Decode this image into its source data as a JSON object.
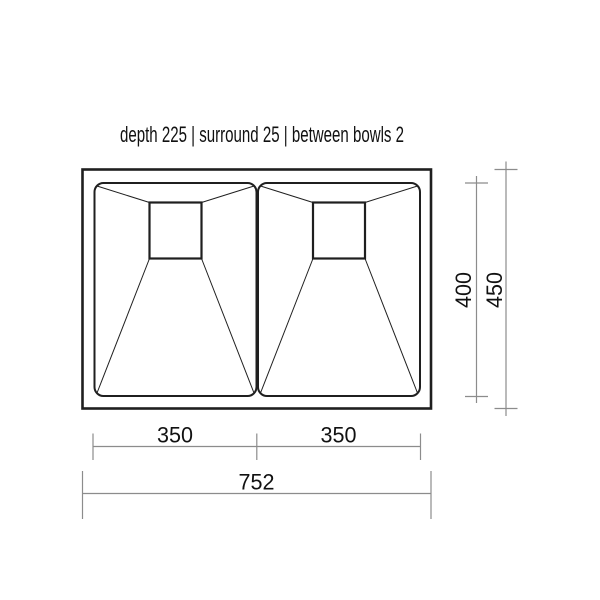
{
  "title": "depth 225 | surround 25 | between bowls 2",
  "spec": {
    "depth": "225",
    "surround": "25",
    "between_bowls": "2"
  },
  "dimensions": {
    "left_bowl_width": "350",
    "right_bowl_width": "350",
    "overall_width": "752",
    "bowl_front_to_back": "400",
    "overall_front_to_back": "450"
  },
  "colors": {
    "line": "#1f1f1f",
    "dimension": "#8c8c8c",
    "text": "#111111",
    "background": "#ffffff"
  }
}
